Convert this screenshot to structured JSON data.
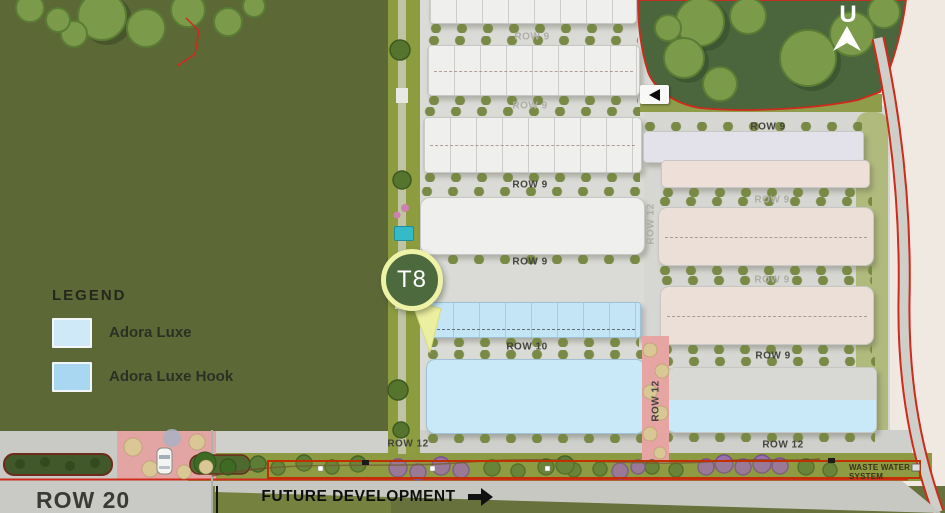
{
  "map": {
    "marker": {
      "label": "T8"
    },
    "compass": {
      "letter": "U"
    },
    "legend": {
      "title": "LEGEND",
      "items": [
        {
          "label": "Adora Luxe",
          "color": "#cfe9f9"
        },
        {
          "label": "Adora Luxe Hook",
          "color": "#a9d6f0"
        }
      ]
    },
    "row_labels": [
      {
        "text": "ROW 9"
      },
      {
        "text": "ROW 9"
      },
      {
        "text": "ROW 9"
      },
      {
        "text": "ROW 9"
      },
      {
        "text": "ROW 10"
      },
      {
        "text": "ROW 12"
      },
      {
        "text": "ROW 9"
      },
      {
        "text": "ROW 9"
      },
      {
        "text": "ROW 9"
      },
      {
        "text": "ROW 9"
      },
      {
        "text": "ROW 12"
      },
      {
        "text": "ROW 12"
      },
      {
        "text": "ROW 12"
      }
    ],
    "street_label": "ROW 20",
    "future_development_label": "FUTURE DEVELOPMENT",
    "waste_water_label": "WASTE WATER SYSTEM",
    "colors": {
      "boundary_red": "#d02f1f",
      "adora_luxe_fill": "#c9e8f8",
      "adora_luxe_hook_fill": "#c3e5f6",
      "marker_fill": "#4c6a3d",
      "marker_ring": "#eef2a6"
    }
  }
}
